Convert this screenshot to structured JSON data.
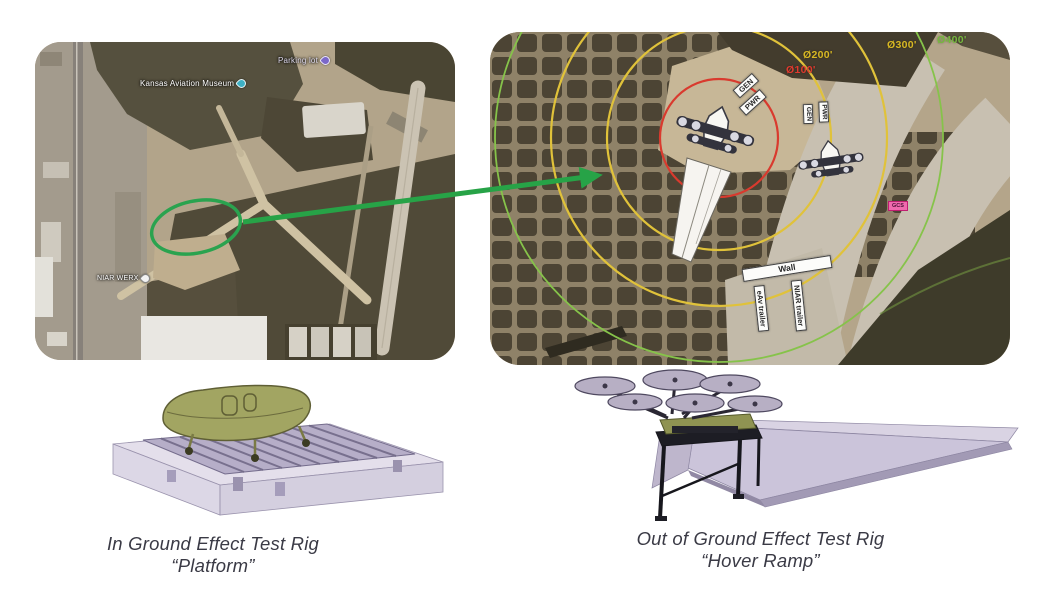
{
  "left_map": {
    "museum_label": "Kansas Aviation Museum",
    "parking_label": "Parking lot",
    "werx_label": "NIAR WERX"
  },
  "right_map": {
    "rings": [
      {
        "label": "Ø100'",
        "color": "#e03a2e"
      },
      {
        "label": "Ø200'",
        "color": "#d8b823"
      },
      {
        "label": "Ø300'",
        "color": "#d8b823"
      },
      {
        "label": "Ø400'",
        "color": "#76b83e"
      }
    ],
    "equipment": {
      "gen": "GEN",
      "pwr": "PWR",
      "wall": "Wall",
      "eav_trailer": "eAv trailer",
      "niar_trailer": "NIAR trailer",
      "gcs": "GCS"
    }
  },
  "annotations": {
    "highlight_color": "#27a347"
  },
  "captions": {
    "platform_line1": "In Ground Effect Test Rig",
    "platform_line2": "“Platform”",
    "hover_line1": "Out of Ground Effect Test Rig",
    "hover_line2": "“Hover Ramp”"
  }
}
